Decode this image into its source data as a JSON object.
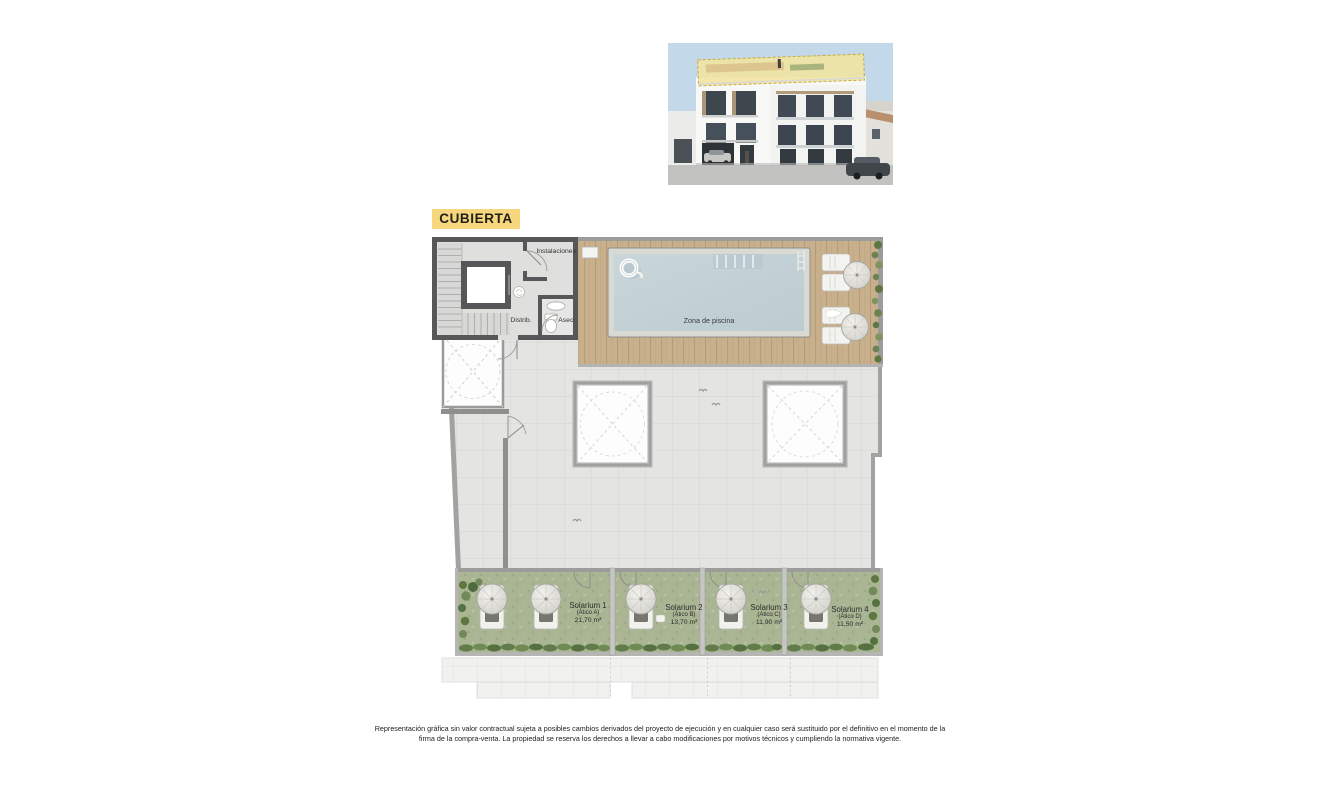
{
  "floor_label": "CUBIERTA",
  "plan": {
    "rooms": {
      "instalaciones": "Instalaciones",
      "distribuidor": "Distrib.",
      "aseo": "Aseo",
      "zona_piscina": "Zona de piscina"
    },
    "solariums": [
      {
        "name": "Solarium 1",
        "unit": "(Ático A)",
        "area": "21,70 m²"
      },
      {
        "name": "Solarium 2",
        "unit": "(Ático B)",
        "area": "13,70 m²"
      },
      {
        "name": "Solarium 3",
        "unit": "(Ático C)",
        "area": "11,90 m²"
      },
      {
        "name": "Solarium 4",
        "unit": "(Ático D)",
        "area": "11,50 m²"
      }
    ]
  },
  "disclaimer": {
    "line1": "Representación gráfica sin valor contractual sujeta a posibles cambios derivados del proyecto de ejecución y en cualquier caso será sustituido por el definitivo en el momento de la",
    "line2": "firma de la compra-venta. La propiedad se reserva los derechos a llevar a cabo modificaciones por motivos técnicos y cumpliendo la normativa vigente."
  },
  "colors": {
    "floor_label_bg": "#f6d77d",
    "wall_dark": "#57575a",
    "pool_water": "#c2d0d5",
    "deck_wood": "#c9b08d",
    "solarium_green": "#a9b593",
    "roof_highlight": "#f1e3a1"
  }
}
